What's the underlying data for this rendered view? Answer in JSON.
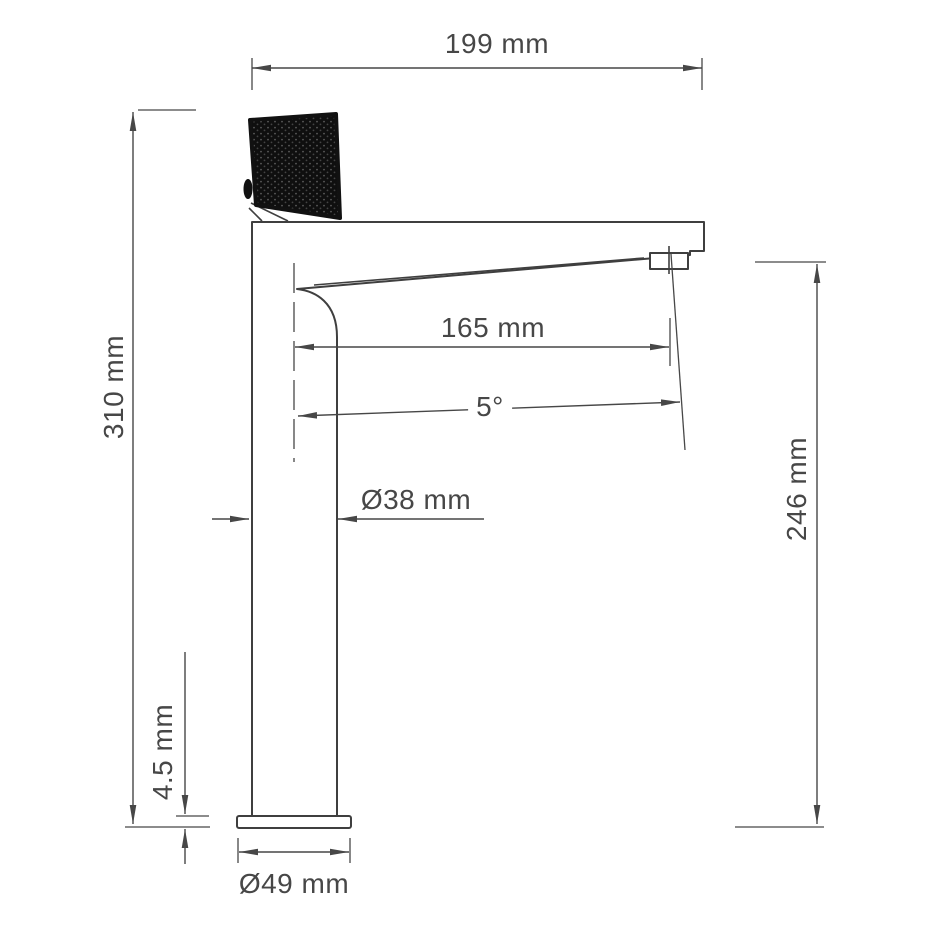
{
  "page": {
    "background": "#ffffff",
    "line_color": "#3f3f3f",
    "dimension_color": "#474747",
    "handle_color": "#0f0f0f"
  },
  "drawing": {
    "name": "Tall single-lever basin mixer, side elevation with dimensions",
    "dimensions": [
      {
        "id": "total-width",
        "label": "199 mm",
        "orientation": "horizontal"
      },
      {
        "id": "total-height",
        "label": "310 mm",
        "orientation": "vertical"
      },
      {
        "id": "spout-reach",
        "label": "165 mm",
        "orientation": "horizontal"
      },
      {
        "id": "spout-angle",
        "label": "5°",
        "orientation": "horizontal"
      },
      {
        "id": "body-diameter",
        "label": "Ø38 mm",
        "orientation": "horizontal"
      },
      {
        "id": "spout-height",
        "label": "246 mm",
        "orientation": "vertical"
      },
      {
        "id": "base-thickness",
        "label": "4.5 mm",
        "orientation": "vertical"
      },
      {
        "id": "base-diameter",
        "label": "Ø49 mm",
        "orientation": "horizontal"
      }
    ]
  }
}
